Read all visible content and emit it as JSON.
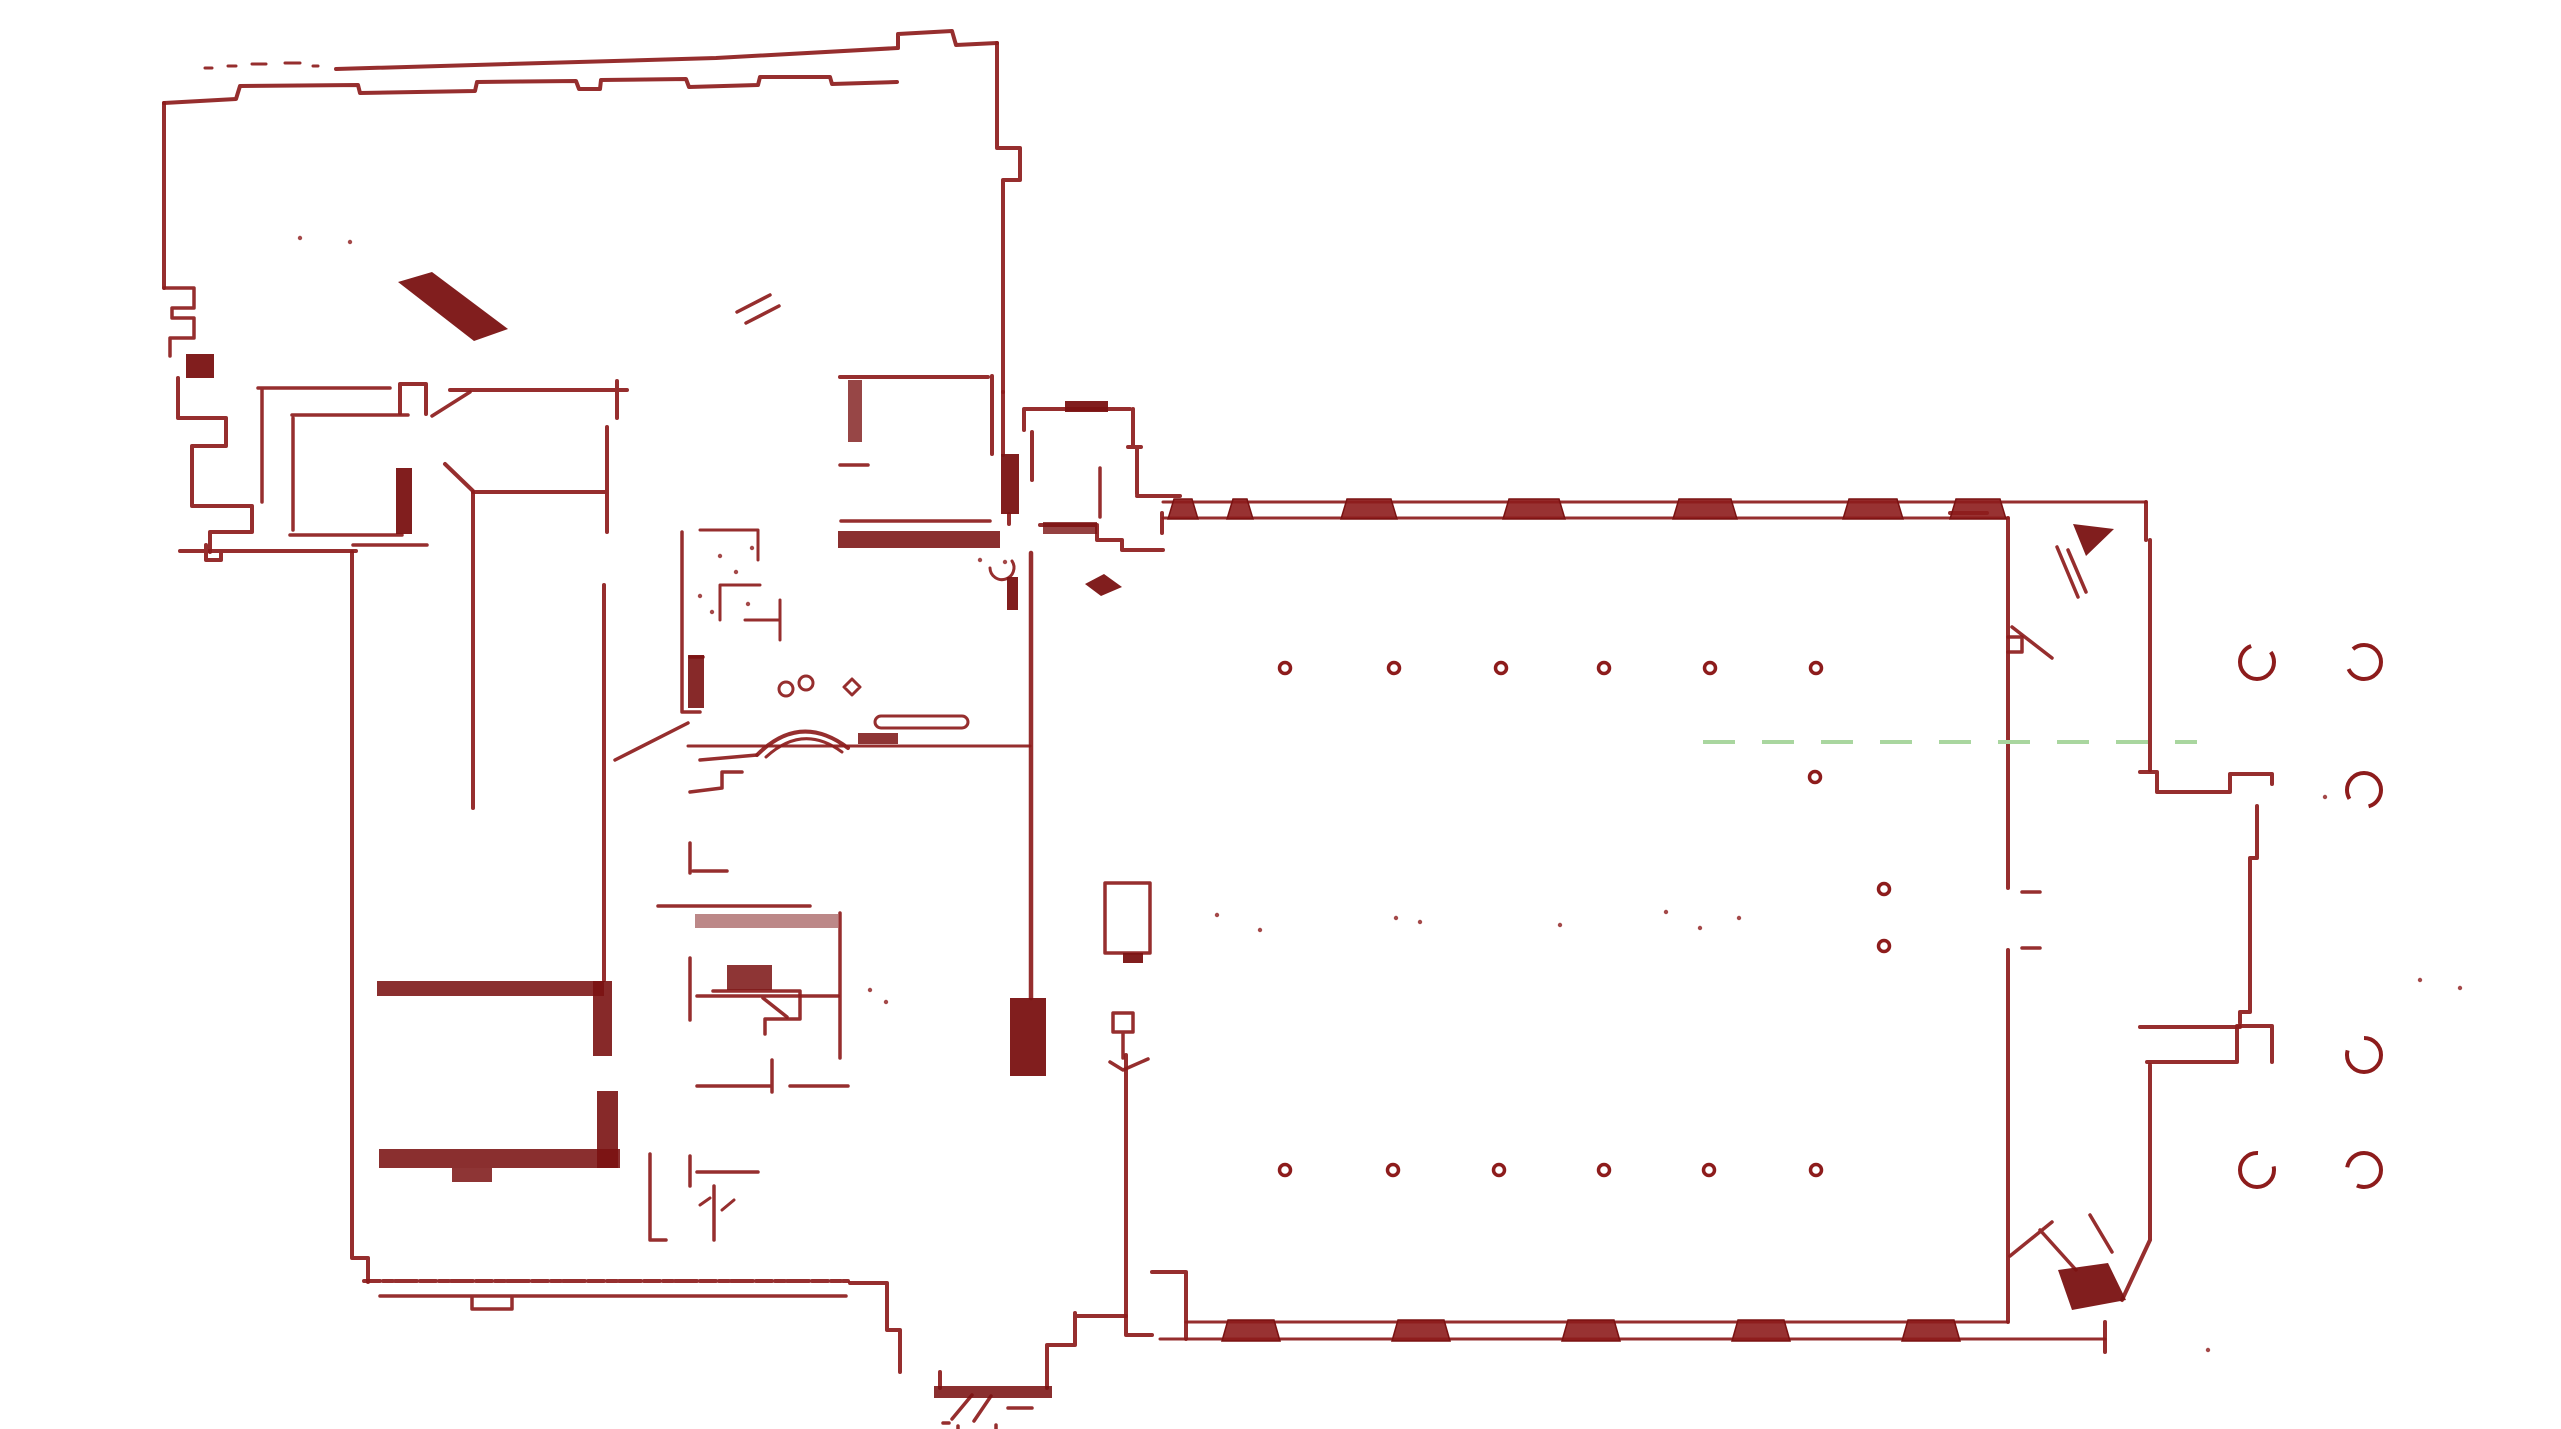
{
  "document": {
    "title": "Building floor plan scan",
    "type": "lidar-floor-plan"
  },
  "canvas": {
    "width": 2561,
    "height": 1429,
    "background": "#ffffff"
  },
  "colors": {
    "wall": "#8d1c1c",
    "wall_dark": "#7a1212",
    "axis_green": "#a9d69f",
    "background": "#ffffff"
  },
  "floor_plan": {
    "walls": [
      {
        "d": "M336,69 L716,58 L898,48 L898,34 L952,31 L956,45 L997,43",
        "w": 4
      },
      {
        "d": "M164,103 L236,99 L240,86 L358,85 L360,93 L475,91 L477,82 L576,81 L579,89 L600,89 L601,80 L686,79 L689,87 L758,85 L760,77 L830,77 L832,84 L897,82",
        "w": 4
      },
      {
        "d": "M997,43 V148 M997,148 H1020 V180 H1003 M1003,180 V392",
        "w": 4
      },
      {
        "d": "M164,103 V288",
        "w": 4
      },
      {
        "d": "M164,288 H194 V308 H172 M172,308 V318 M172,318 H194 V338 H170 V356",
        "w": 3.5
      },
      {
        "d": "M178,378 V418 H226 V446 H192 V506 H252 V532 H210 V552",
        "w": 4
      },
      {
        "d": "M180,551 H356 M206,545 V560 H221 V551",
        "w": 4
      },
      {
        "d": "M737,312 L770,295 M746,323 L779,306",
        "w": 3.5
      },
      {
        "d": "M205,68 H212 M228,66 H236 M252,64 H266 M285,63 H300 M313,66 H318",
        "w": 3
      },
      {
        "d": "M258,388 H390 M262,388 V502",
        "w": 3.5
      },
      {
        "d": "M292,415 H408 M293,418 V530",
        "w": 3.5
      },
      {
        "d": "M400,413 V384 H426 V414",
        "w": 4
      },
      {
        "d": "M450,390 H627 M617,381 V418",
        "w": 4
      },
      {
        "d": "M432,416 L470,392",
        "w": 3.5
      },
      {
        "d": "M445,464 L473,491 M473,492 H607 M607,427 V532",
        "w": 4
      },
      {
        "d": "M290,535 H402 M353,545 H427",
        "w": 3.5
      },
      {
        "d": "M473,492 V808",
        "w": 4
      },
      {
        "d": "M604,585 V980",
        "w": 4
      },
      {
        "d": "M840,377 H988",
        "w": 4
      },
      {
        "d": "M840,465 H868",
        "w": 3.5
      },
      {
        "d": "M992,376 V454 M1009,514 V524",
        "w": 4
      },
      {
        "d": "M841,521 H990",
        "w": 3.5
      },
      {
        "d": "M1024,430 V409 H1130 M1133,409 V446 M1128,447 H1141 M1137,447 V494 M1137,496 H1180 M1032,432 V480",
        "w": 4
      },
      {
        "d": "M1040,525 H1097 M1097,526 V540 H1122 V550 H1163 M1162,513 V533",
        "w": 4
      },
      {
        "d": "M1031,553 V998",
        "w": 4.5
      },
      {
        "d": "M990,568 a12,12 0 1 0 22,-7",
        "w": 3
      },
      {
        "d": "M1100,468 V517",
        "w": 3.5
      },
      {
        "d": "M1163,502 H2146",
        "w": 3
      },
      {
        "d": "M1163,518 H2008",
        "w": 3
      },
      {
        "d": "M1186,1322 H2008",
        "w": 3
      },
      {
        "d": "M1160,1339 H2105",
        "w": 3
      },
      {
        "d": "M1152,1272 H1186 V1339",
        "w": 4
      },
      {
        "d": "M2008,518 V888 M2008,950 V1322",
        "w": 4
      },
      {
        "d": "M2022,892 H2040 M2022,948 H2040",
        "w": 3.5
      },
      {
        "d": "M2008,637 H2022 V652 H2008",
        "w": 3.5
      },
      {
        "d": "M2012,627 L2052,658 M2057,547 L2078,597 M2068,550 L2086,592",
        "w": 3.5
      },
      {
        "d": "M2146,502 V540 M2150,540 V770 M1950,513 H1987",
        "w": 4
      },
      {
        "d": "M2010,1256 L2052,1222 M2040,1230 L2076,1270 M2090,1215 L2112,1252",
        "w": 3.5
      },
      {
        "d": "M2105,1322 V1352 M2150,1065 V1240 M2150,1240 L2122,1300",
        "w": 4
      },
      {
        "d": "M2140,772 H2157 V792 H2230 V774 H2272 V784",
        "w": 4
      },
      {
        "d": "M2257,806 V858 H2250 V1012 M2250,1012 H2240 V1023 M2140,1027 H2240",
        "w": 4
      },
      {
        "d": "M2147,1062 H2237 M2237,1062 V1026 H2272 V1062",
        "w": 4
      },
      {
        "d": "M352,552 V1258 M352,1258 H368 V1282",
        "w": 4
      },
      {
        "d": "M364,1281 H848",
        "w": 4,
        "dash": "16 3 10 2 22 3"
      },
      {
        "d": "M380,1296 H846 M472,1296 V1309 H512 V1298",
        "w": 3.5
      },
      {
        "d": "M650,1154 V1240 H666 M690,1156 V1186 M697,1172 H758 M714,1186 V1240",
        "w": 3.5
      },
      {
        "d": "M700,1205 L710,1198 M722,1210 L734,1200",
        "w": 3
      },
      {
        "d": "M690,843 V873 M693,871 H727 M658,906 H810 M840,913 V1058",
        "w": 3.5
      },
      {
        "d": "M690,958 V1020 M713,991 H800 M800,991 V1019 M765,1019 H800 M765,1019 V1034 M697,1086 H772 M772,1060 V1092 M790,1086 H848",
        "w": 3.5
      },
      {
        "d": "M697,996 H838 M763,998 L787,1017",
        "w": 3.5
      },
      {
        "d": "M757,755 Q800,712 848,748",
        "w": 4
      },
      {
        "d": "M766,757 Q803,723 842,752",
        "w": 3
      },
      {
        "d": "M700,760 L757,755 M690,792 L722,788 M722,788 V772 H742",
        "w": 3.5
      },
      {
        "d": "M615,760 L688,723",
        "w": 3.5
      },
      {
        "d": "M688,746 H1030",
        "w": 3
      },
      {
        "d": "M881,716 H962 a6,6 0 0 1 0,12 H881 a6,6 0 0 1 0,-12 Z",
        "w": 3
      },
      {
        "d": "M682,532 V712 M690,657 H703 M682,712 H700",
        "w": 3.5
      },
      {
        "d": "M700,530 H758 M758,530 V560 M720,585 H760 M720,585 V620 M745,620 H780 M780,600 V640",
        "w": 3
      },
      {
        "d": "M786,689 m-7,0 a7,7 0 1 0 14,0 a7,7 0 1 0 -14,0 M806,683 m-7,0 a7,7 0 1 0 14,0 a7,7 0 1 0 -14,0 M852,679 L860,687 L852,695 L844,687 Z",
        "w": 3
      },
      {
        "d": "M850,1283 H887 V1330 H900 V1372 M940,1372 V1388 M1047,1345 V1388 M1047,1345 H1075 M1075,1313 V1345 M1077,1316 H1126",
        "w": 4
      },
      {
        "d": "M952,1419 L972,1395 M974,1421 L991,1396 M943,1423 H949 M1008,1408 H1032 M958,1426 V1429 M996,1425 V1429",
        "w": 3.5
      },
      {
        "d": "M1126,1055 V1335 M1126,1335 H1152",
        "w": 4
      },
      {
        "d": "M1105,883 H1150 V953 H1105 Z",
        "w": 3.5
      },
      {
        "d": "M1113,1013 H1133 V1032 H1113 Z M1123,1032 V1058 M1110,1062 L1123,1070 L1148,1059",
        "w": 3.5
      },
      {
        "d": "M1003,392 V455",
        "w": 4
      }
    ],
    "fills": [
      {
        "d": "M186,354 H214 V378 H186 Z"
      },
      {
        "d": "M398,282 L432,272 L508,329 L474,341 Z"
      },
      {
        "d": "M396,468 H412 V534 H396 Z"
      },
      {
        "d": "M848,380 H862 V442 H848 Z",
        "o": 0.78
      },
      {
        "d": "M1001,454 H1019 V514 H1001 Z"
      },
      {
        "d": "M838,531 H1000 V548 H838 Z",
        "o": 0.88
      },
      {
        "d": "M1065,401 H1108 V412 H1065 Z"
      },
      {
        "d": "M1043,522 H1097 V534 H1043 Z",
        "o": 0.8
      },
      {
        "d": "M1010,998 H1046 V1076 H1010 Z"
      },
      {
        "d": "M1085,584 L1104,574 L1122,587 L1101,596 Z"
      },
      {
        "d": "M1007,577 H1018 V610 H1007 Z"
      },
      {
        "d": "M2073,524 L2114,529 L2086,556 Z"
      },
      {
        "d": "M2058,1270 L2108,1263 L2126,1300 L2072,1310 Z"
      },
      {
        "d": "M377,981 H604 V996 H377 Z",
        "o": 0.88
      },
      {
        "d": "M593,981 H612 V1056 H593 Z",
        "o": 0.9
      },
      {
        "d": "M379,1149 H620 V1168 H379 Z",
        "o": 0.88
      },
      {
        "d": "M597,1091 H618 V1168 H597 Z",
        "o": 0.9
      },
      {
        "d": "M452,1168 H492 V1182 H452 Z",
        "o": 0.85
      },
      {
        "d": "M695,914 H838 V928 H695 Z",
        "o": 0.5
      },
      {
        "d": "M727,965 H772 V990 H727 Z",
        "o": 0.85
      },
      {
        "d": "M688,655 H704 V708 H688 Z",
        "o": 0.9
      },
      {
        "d": "M858,733 H898 V744 H858 Z",
        "o": 0.85
      },
      {
        "d": "M934,1386 H1052 V1398 H934 Z",
        "o": 0.88
      },
      {
        "d": "M1123,953 H1143 V963 H1123 Z"
      }
    ],
    "piers_top": {
      "y": 499,
      "h": 20,
      "xs": [
        1168,
        1227,
        1341,
        1503,
        1673,
        1843,
        1950
      ],
      "widths": [
        30,
        26,
        56,
        62,
        64,
        60,
        56
      ]
    },
    "piers_bottom": {
      "y": 1320,
      "h": 21,
      "xs": [
        1222,
        1392,
        1562,
        1732,
        1902
      ],
      "widths": [
        58,
        58,
        58,
        58,
        58
      ]
    },
    "small_columns": {
      "r": 5.5,
      "stroke_w": 3.5,
      "centers": [
        [
          1285,
          668
        ],
        [
          1394,
          668
        ],
        [
          1501,
          668
        ],
        [
          1604,
          668
        ],
        [
          1710,
          668
        ],
        [
          1816,
          668
        ],
        [
          1285,
          1170
        ],
        [
          1393,
          1170
        ],
        [
          1499,
          1170
        ],
        [
          1604,
          1170
        ],
        [
          1709,
          1170
        ],
        [
          1816,
          1170
        ],
        [
          1815,
          777
        ],
        [
          1884,
          889
        ],
        [
          1884,
          946
        ]
      ]
    },
    "large_columns": {
      "r": 17,
      "stroke_w": 4,
      "dash": "86 22",
      "offsets": [
        12,
        40,
        64,
        28,
        5,
        52
      ],
      "centers": [
        [
          2257,
          662
        ],
        [
          2364,
          662
        ],
        [
          2364,
          790
        ],
        [
          2364,
          1055
        ],
        [
          2257,
          1170
        ],
        [
          2364,
          1170
        ]
      ]
    },
    "axis_line": {
      "x1": 1703,
      "y1": 742,
      "x2": 2197,
      "y2": 742,
      "w": 4,
      "dash": "32 27"
    },
    "specks": [
      [
        2325,
        797
      ],
      [
        2420,
        980
      ],
      [
        2460,
        988
      ],
      [
        2208,
        1350
      ],
      [
        1217,
        915
      ],
      [
        1396,
        918
      ],
      [
        1420,
        922
      ],
      [
        1666,
        912
      ],
      [
        1700,
        928
      ],
      [
        1739,
        918
      ],
      [
        1260,
        930
      ],
      [
        1560,
        925
      ],
      [
        720,
        556
      ],
      [
        736,
        572
      ],
      [
        752,
        548
      ],
      [
        700,
        596
      ],
      [
        712,
        612
      ],
      [
        748,
        604
      ],
      [
        300,
        238
      ],
      [
        350,
        242
      ],
      [
        980,
        560
      ],
      [
        1005,
        562
      ],
      [
        870,
        990
      ],
      [
        886,
        1002
      ]
    ]
  }
}
